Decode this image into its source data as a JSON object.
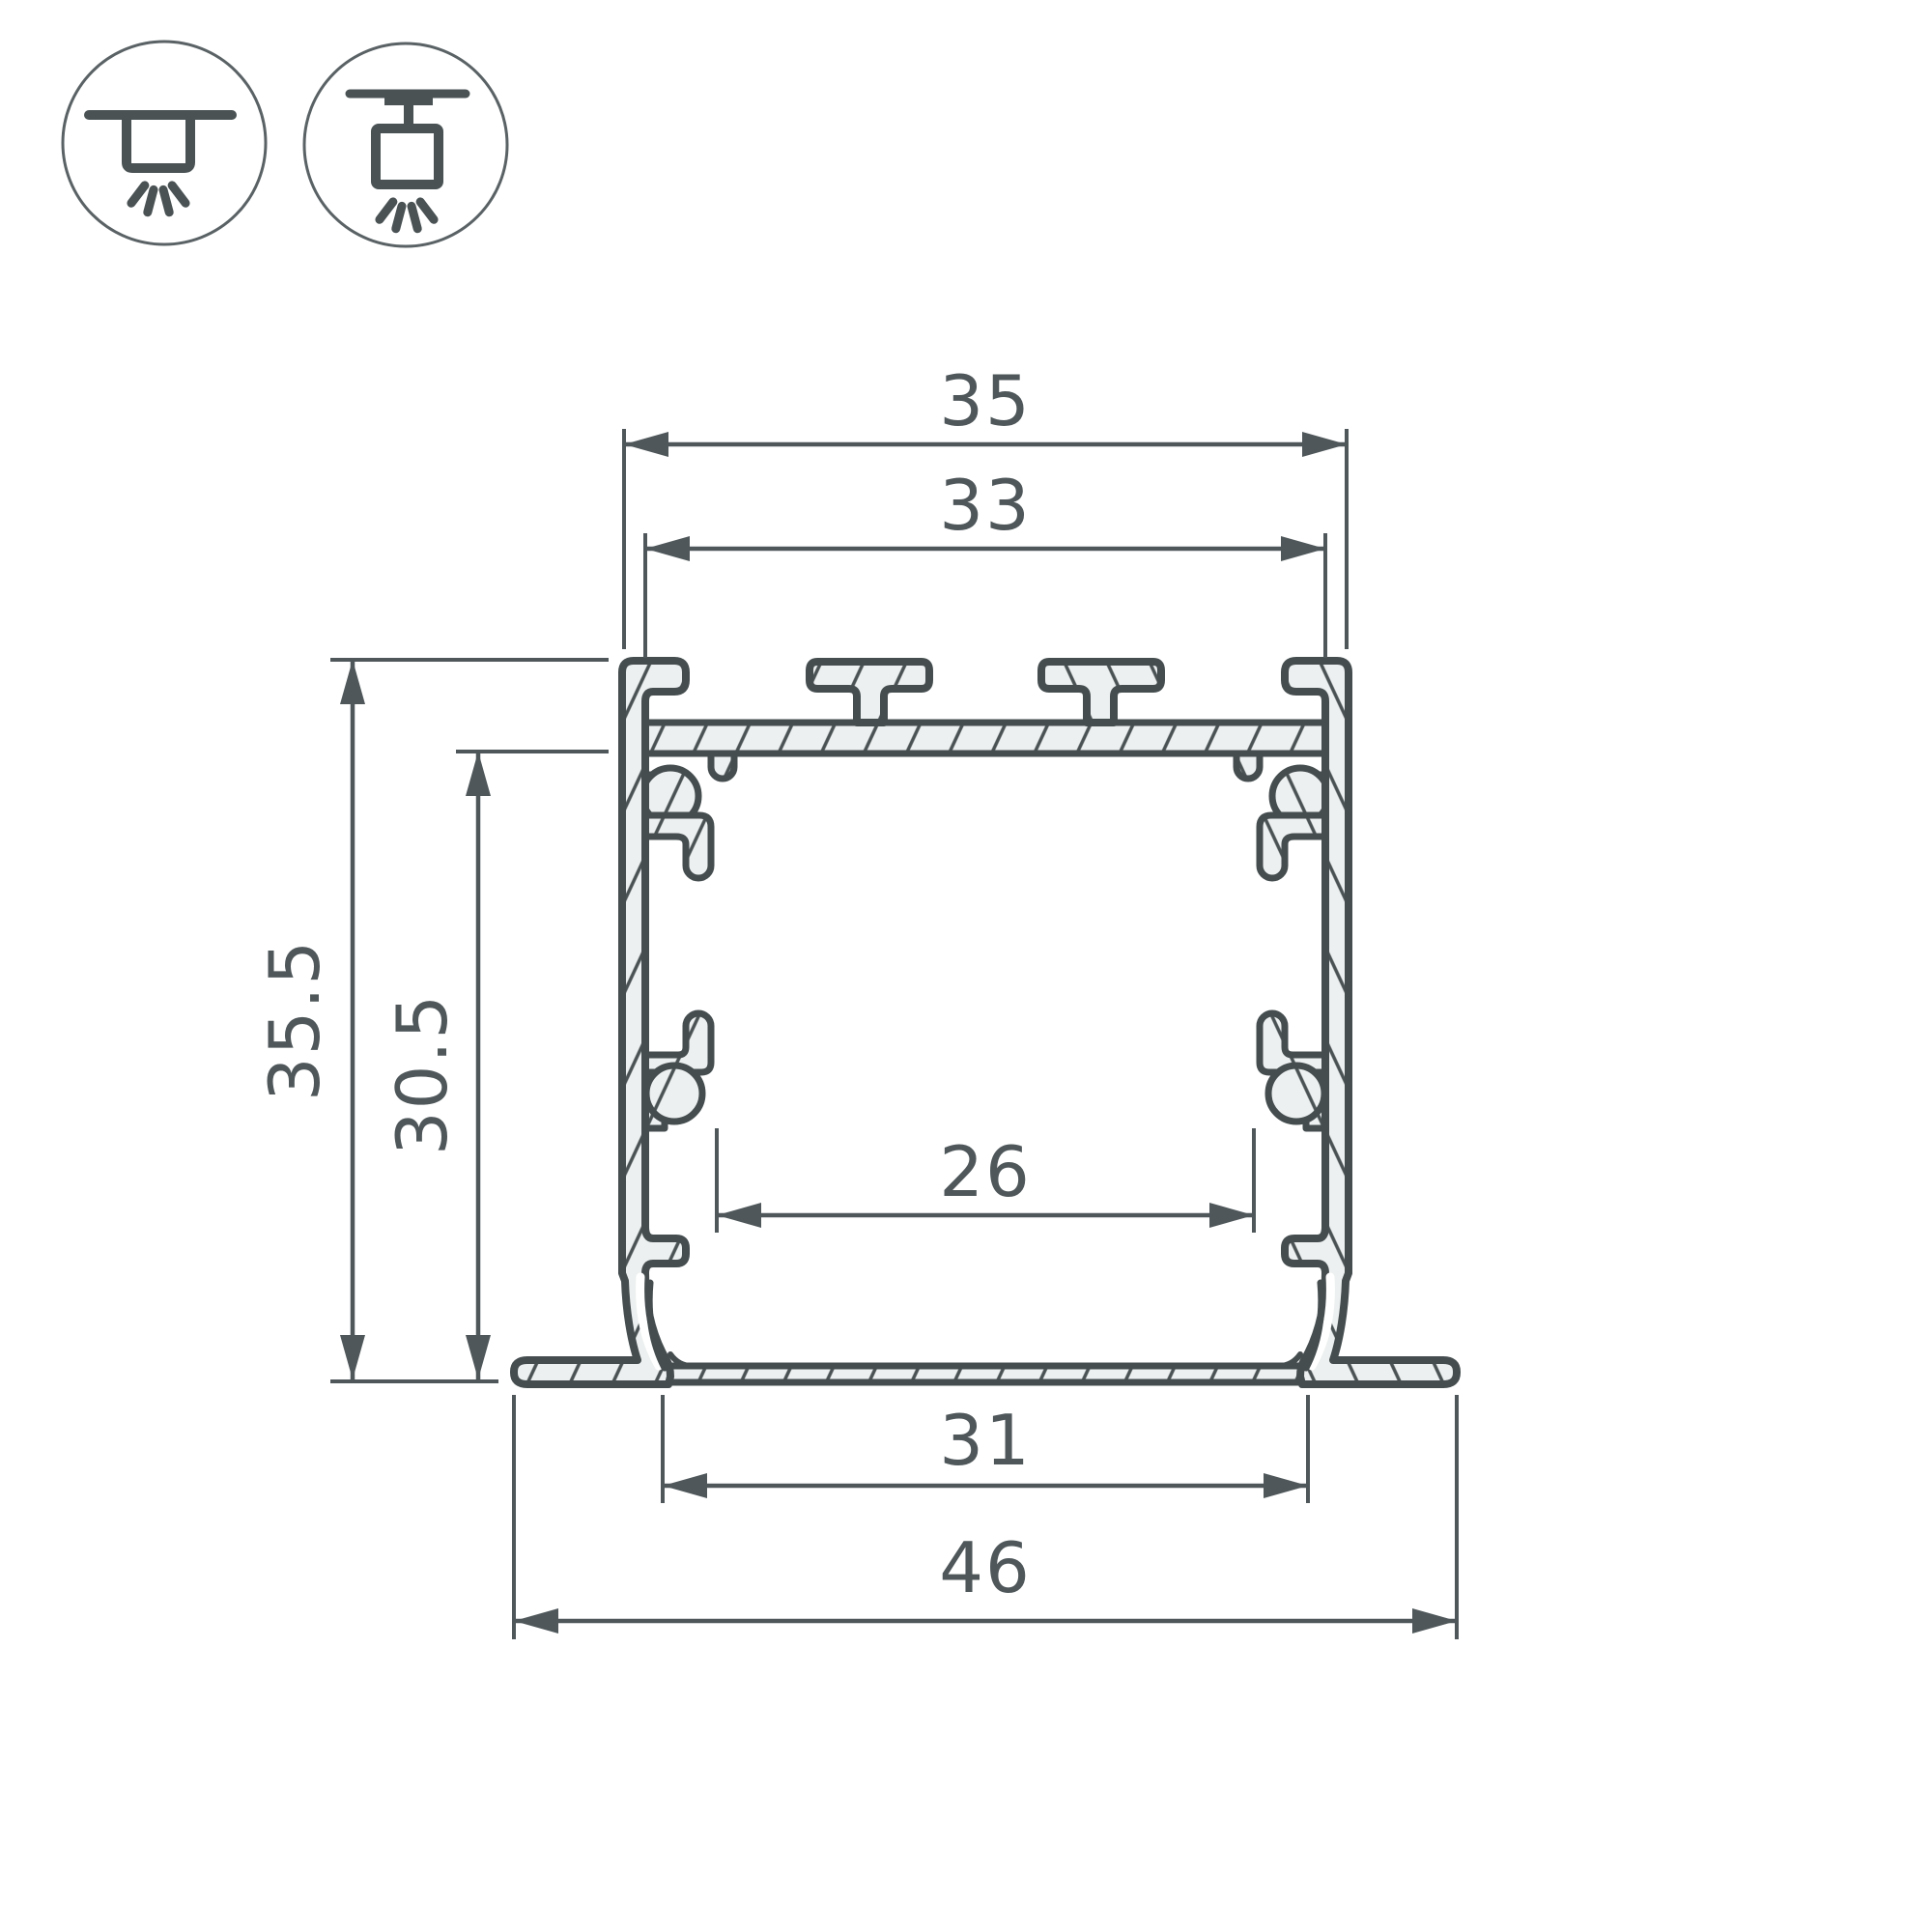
{
  "drawing": {
    "type": "technical-cross-section",
    "subject": "recessed-led-aluminum-profile",
    "units": "mm",
    "dimensions": {
      "outer_top_width": "35",
      "mounting_slot_width": "33",
      "total_height": "35.5",
      "inner_height": "30.5",
      "inner_width": "26",
      "recess_width": "31",
      "flange_width": "46"
    },
    "icons": [
      {
        "name": "recessed-mount-icon"
      },
      {
        "name": "surface-mount-icon"
      }
    ],
    "colors": {
      "outline": "#454d4f",
      "dimension": "#4f575a",
      "metal_fill": "#edf0f0",
      "background": "#ffffff"
    }
  }
}
